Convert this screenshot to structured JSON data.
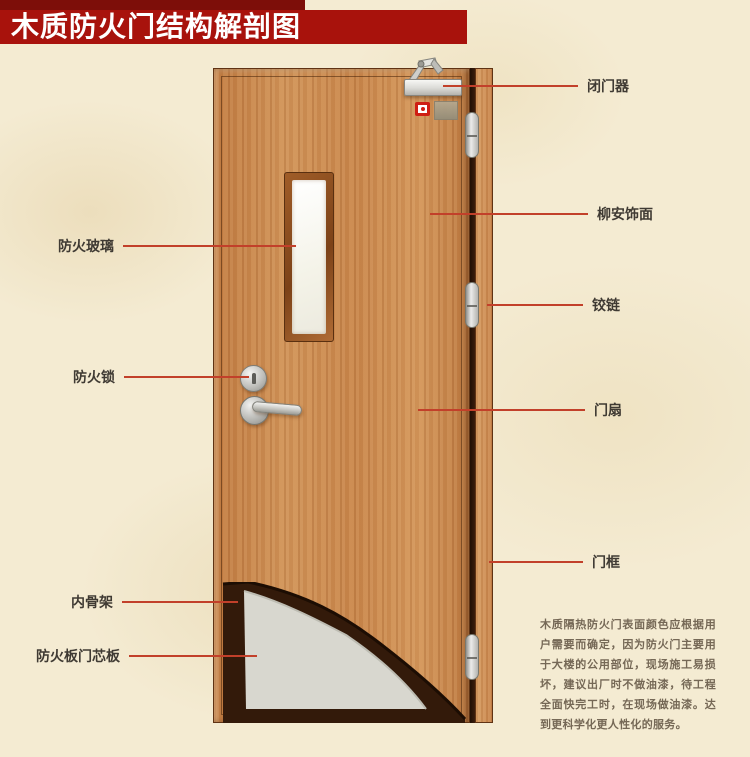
{
  "title": "木质防火门结构解剖图",
  "annotations": {
    "left": [
      {
        "label": "防火玻璃"
      },
      {
        "label": "防火锁"
      },
      {
        "label": "内骨架"
      },
      {
        "label": "防火板门芯板"
      }
    ],
    "right": [
      {
        "label": "闭门器"
      },
      {
        "label": "柳安饰面"
      },
      {
        "label": "铰链"
      },
      {
        "label": "门扇"
      },
      {
        "label": "门框"
      }
    ]
  },
  "description": "木质隔热防火门表面颜色应根据用户需要而确定，因为防火门主要用于大楼的公用部位，现场施工易损坏，建议出厂时不做油漆，待工程全面快完工时，在现场做油漆。达到更科学化更人性化的服务。",
  "colors": {
    "banner": "#a8120c",
    "banner_top_strip": "#7d0e09",
    "annotation_line": "#c2402a",
    "door_wood": "#c8854a",
    "frame_wood": "#d79d63",
    "glass": "#f4f3e8",
    "core_panel": "#d8d7cf",
    "inner_skeleton": "#331a0a",
    "background": "#f4ebd2",
    "label_text": "#3f3a33",
    "description_text": "#756856"
  }
}
